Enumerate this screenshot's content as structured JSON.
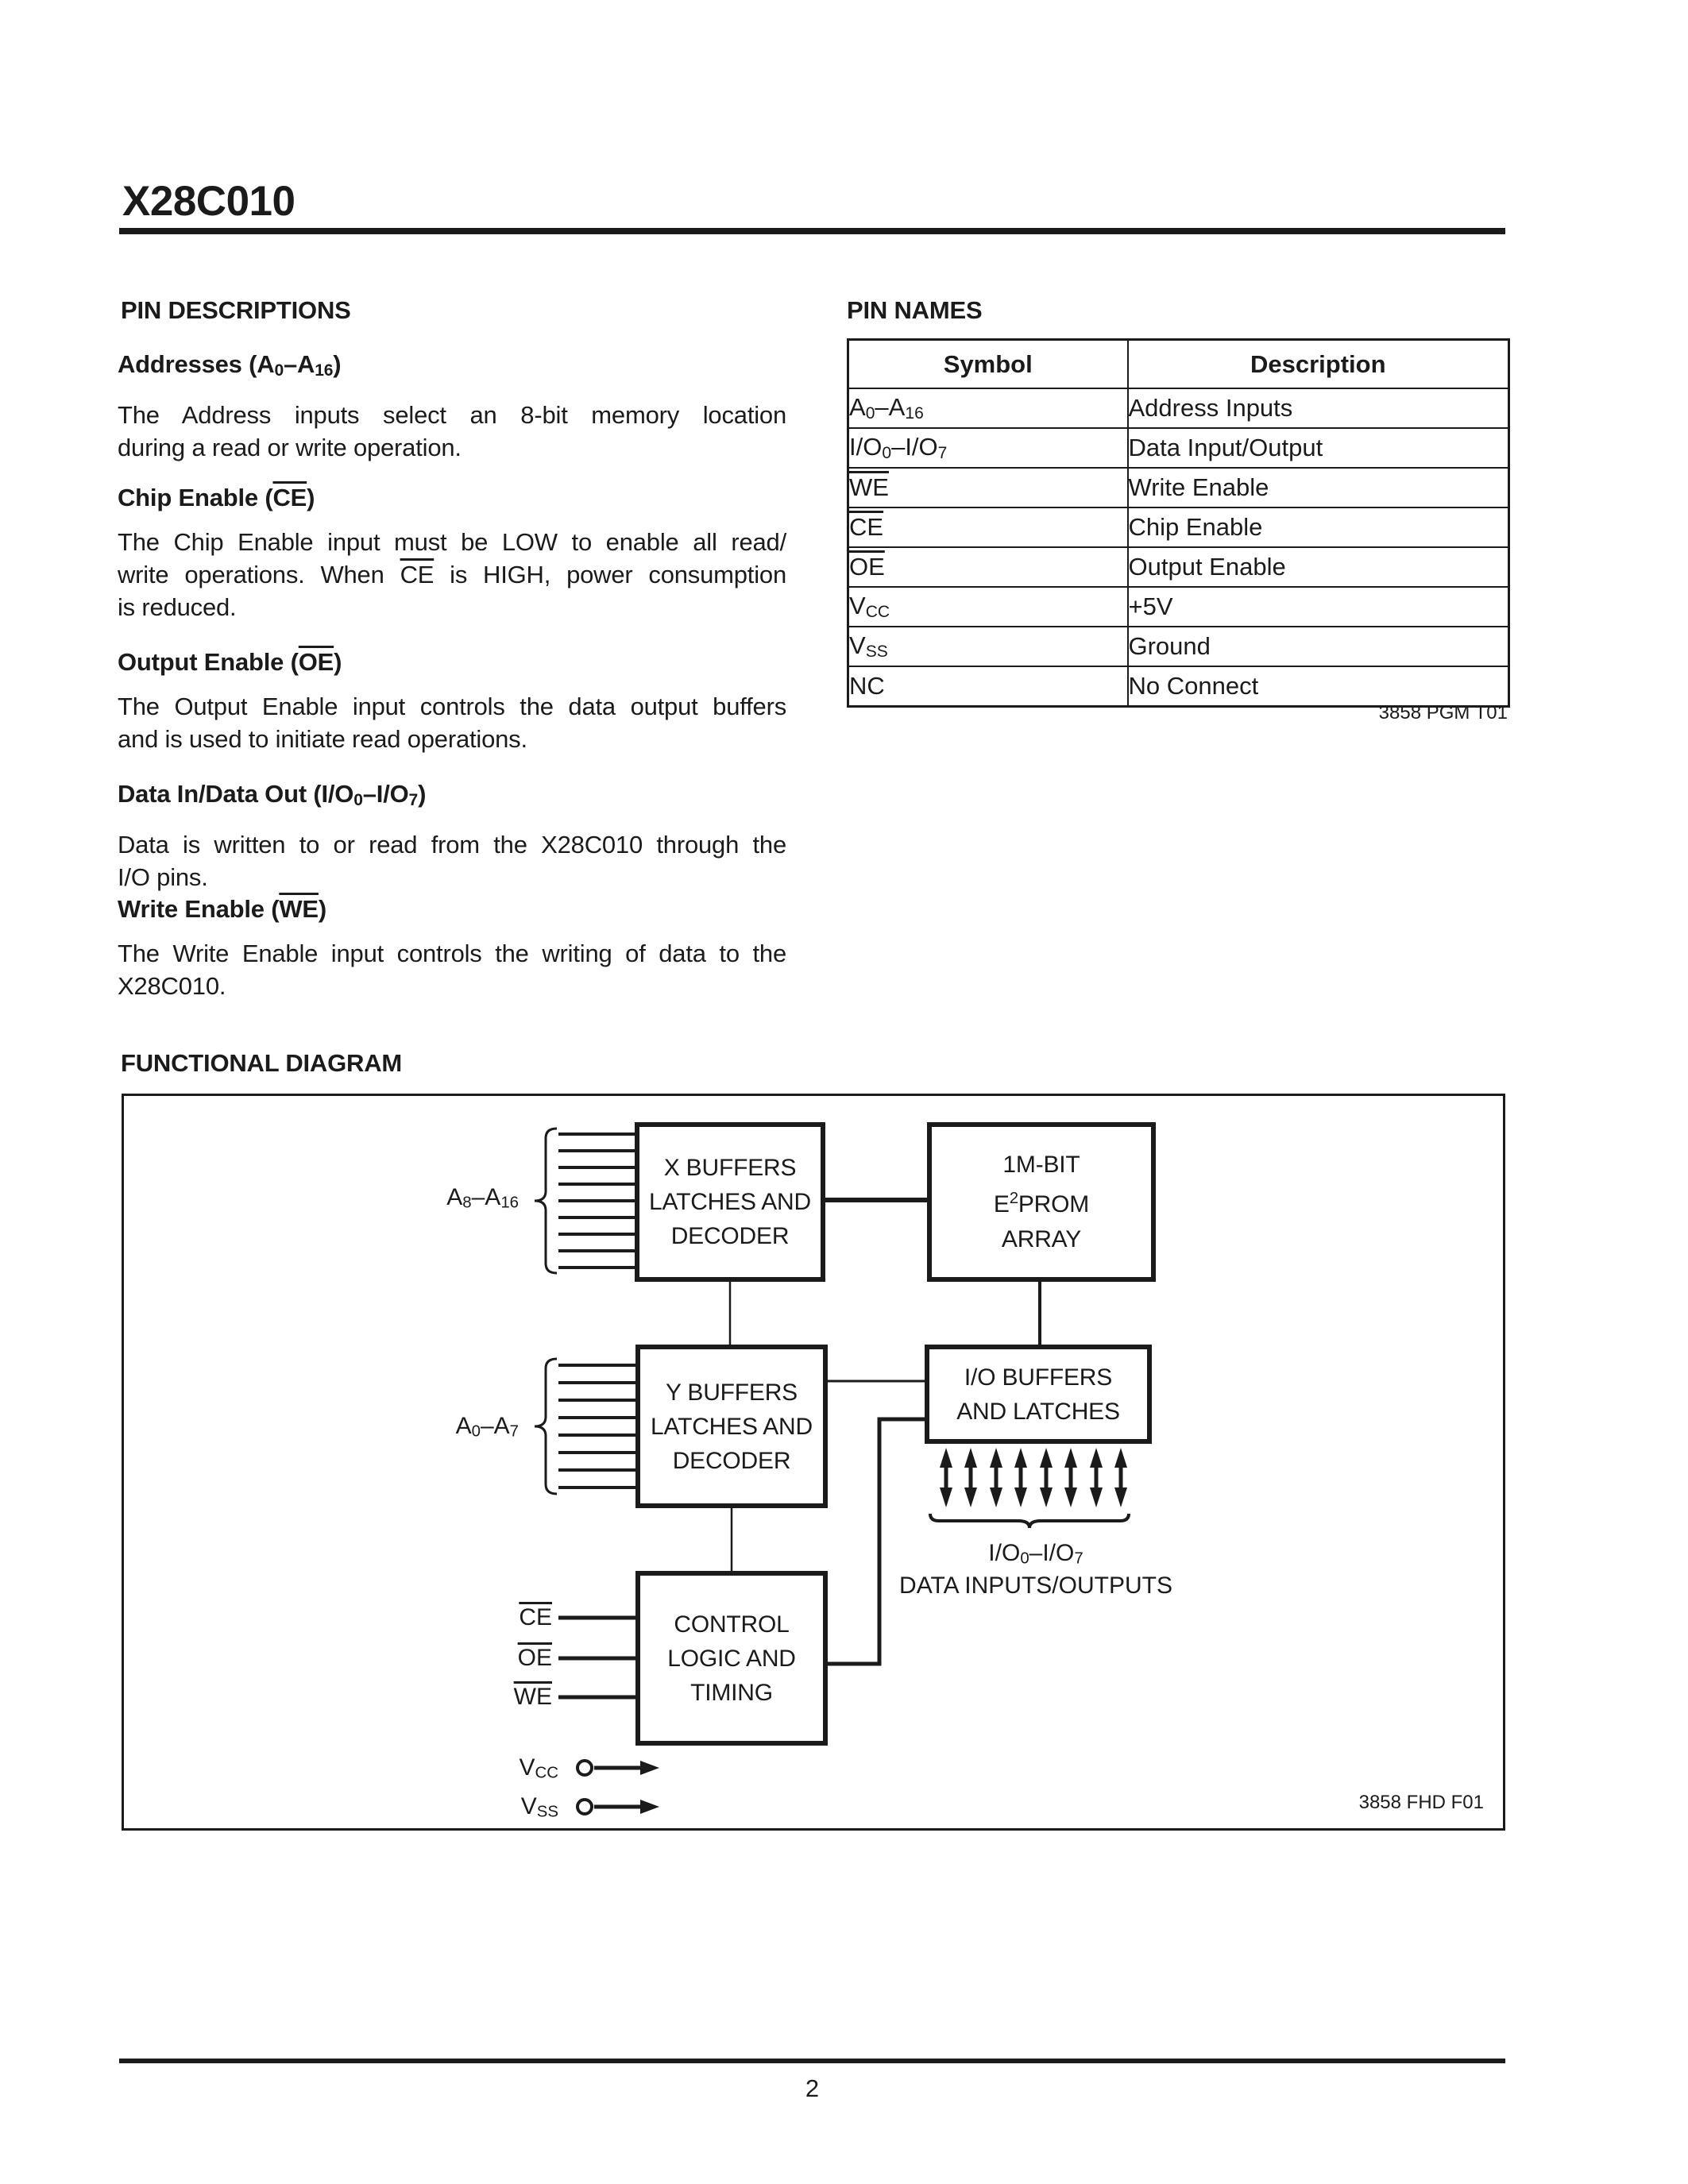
{
  "colors": {
    "ink": "#1b1b1b",
    "paper": "#ffffff"
  },
  "page": {
    "title": "X28C010",
    "page_number": "2"
  },
  "left_column": {
    "heading": "PIN DESCRIPTIONS",
    "sections": [
      {
        "heading": [
          {
            "t": "Addresses (A"
          },
          {
            "t": "0",
            "fmt": "sub"
          },
          {
            "t": "–A"
          },
          {
            "t": "16",
            "fmt": "sub"
          },
          {
            "t": ")"
          }
        ],
        "body": [
          "The Address inputs select an 8-bit memory location",
          "during a read or write operation."
        ]
      },
      {
        "heading": [
          {
            "t": "Chip Enable ("
          },
          {
            "t": "CE",
            "fmt": "ov"
          },
          {
            "t": ")"
          }
        ],
        "body": [
          "The Chip Enable input must be LOW to enable all read/",
          [
            {
              "t": "write operations. When "
            },
            {
              "t": "CE",
              "fmt": "ov"
            },
            {
              "t": " is HIGH, power consumption"
            }
          ],
          "is reduced."
        ]
      },
      {
        "heading": [
          {
            "t": "Output Enable ("
          },
          {
            "t": "OE",
            "fmt": "ov"
          },
          {
            "t": ")"
          }
        ],
        "body": [
          "The Output Enable input controls the data output buffers",
          "and is used to initiate read operations."
        ]
      },
      {
        "heading": [
          {
            "t": "Data In/Data Out (I/O"
          },
          {
            "t": "0",
            "fmt": "sub"
          },
          {
            "t": "–I/O"
          },
          {
            "t": "7",
            "fmt": "sub"
          },
          {
            "t": ")"
          }
        ],
        "body": [
          "Data is written to or read from the X28C010 through the",
          "I/O pins."
        ]
      },
      {
        "heading": [
          {
            "t": "Write Enable ("
          },
          {
            "t": "WE",
            "fmt": "ov"
          },
          {
            "t": ")"
          }
        ],
        "body": [
          "The Write Enable input controls the writing of data to the",
          "X28C010."
        ]
      }
    ]
  },
  "pin_names": {
    "heading": "PIN NAMES",
    "caption": "3858 PGM T01",
    "table": {
      "headers": [
        "Symbol",
        "Description"
      ],
      "rows": [
        {
          "symbol": [
            {
              "t": "A"
            },
            {
              "t": "0",
              "fmt": "sub"
            },
            {
              "t": "–A"
            },
            {
              "t": "16",
              "fmt": "sub"
            }
          ],
          "description": "Address Inputs"
        },
        {
          "symbol": [
            {
              "t": "I/O"
            },
            {
              "t": "0",
              "fmt": "sub"
            },
            {
              "t": "–I/O"
            },
            {
              "t": "7",
              "fmt": "sub"
            }
          ],
          "description": "Data Input/Output"
        },
        {
          "symbol": [
            {
              "t": "WE",
              "fmt": "ov"
            }
          ],
          "description": "Write Enable"
        },
        {
          "symbol": [
            {
              "t": "CE",
              "fmt": "ov"
            }
          ],
          "description": "Chip Enable"
        },
        {
          "symbol": [
            {
              "t": "OE",
              "fmt": "ov"
            }
          ],
          "description": "Output Enable"
        },
        {
          "symbol": [
            {
              "t": "V"
            },
            {
              "t": "CC",
              "fmt": "sub"
            }
          ],
          "description": "+5V"
        },
        {
          "symbol": [
            {
              "t": "V"
            },
            {
              "t": "SS",
              "fmt": "sub"
            }
          ],
          "description": "Ground"
        },
        {
          "symbol": [
            {
              "t": "NC"
            }
          ],
          "description": "No Connect"
        }
      ]
    }
  },
  "functional_diagram": {
    "heading": "FUNCTIONAL DIAGRAM",
    "caption": "3858 FHD F01",
    "blocks": {
      "x_buffers": [
        "X BUFFERS",
        "LATCHES AND",
        "DECODER"
      ],
      "eeprom": [
        "1M-BIT",
        [
          {
            "t": "E"
          },
          {
            "t": "2",
            "fmt": "sup"
          },
          {
            "t": "PROM"
          }
        ],
        "ARRAY"
      ],
      "y_buffers": [
        "Y BUFFERS",
        "LATCHES AND",
        "DECODER"
      ],
      "io_buffers": [
        "I/O BUFFERS",
        "AND LATCHES"
      ],
      "control": [
        "CONTROL",
        "LOGIC AND",
        "TIMING"
      ]
    },
    "labels": {
      "a8_a16": [
        {
          "t": "A"
        },
        {
          "t": "8",
          "fmt": "sub"
        },
        {
          "t": "–A"
        },
        {
          "t": "16",
          "fmt": "sub"
        }
      ],
      "a0_a7": [
        {
          "t": "A"
        },
        {
          "t": "0",
          "fmt": "sub"
        },
        {
          "t": "–A"
        },
        {
          "t": "7",
          "fmt": "sub"
        }
      ],
      "ce": [
        {
          "t": "CE",
          "fmt": "ov"
        }
      ],
      "oe": [
        {
          "t": "OE",
          "fmt": "ov"
        }
      ],
      "we": [
        {
          "t": "WE",
          "fmt": "ov"
        }
      ],
      "vcc": [
        {
          "t": "V"
        },
        {
          "t": "CC",
          "fmt": "sub"
        }
      ],
      "vss": [
        {
          "t": "V"
        },
        {
          "t": "SS",
          "fmt": "sub"
        }
      ],
      "io_range": [
        {
          "t": "I/O"
        },
        {
          "t": "0",
          "fmt": "sub"
        },
        {
          "t": "–I/O"
        },
        {
          "t": "7",
          "fmt": "sub"
        }
      ],
      "io_caption": "DATA INPUTS/OUTPUTS"
    }
  }
}
